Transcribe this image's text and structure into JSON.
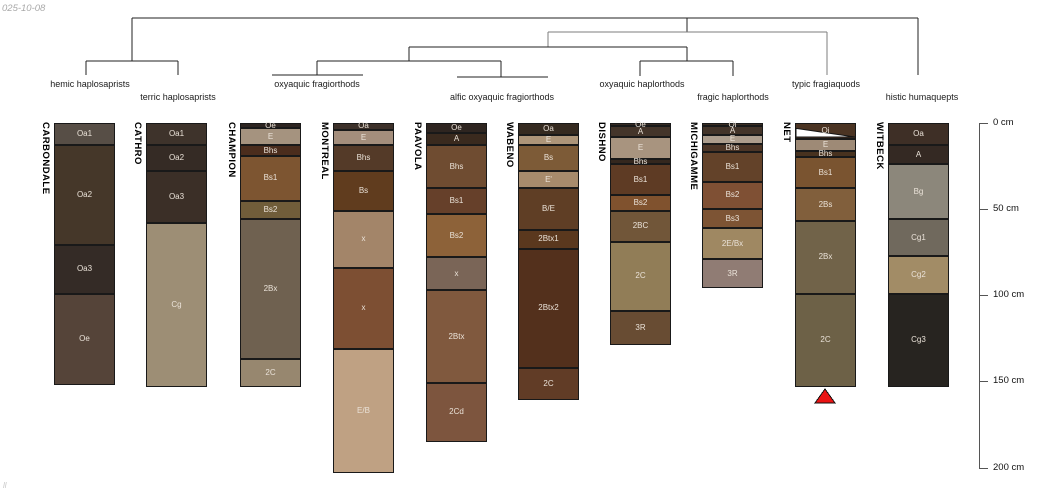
{
  "meta": {
    "date_label": "025-10-08",
    "corner_mark": "ll"
  },
  "chart_data": {
    "type": "soil-profile-dendrogram",
    "depth_axis": {
      "unit": "cm",
      "x_px": 979,
      "top_px": 123,
      "px_per_cm": 1.7226,
      "tick_len_px": 9,
      "label_x_px": 993,
      "ticks": [
        0,
        50,
        100,
        150,
        200
      ],
      "tick_labels": [
        "0 cm",
        "50 cm",
        "100 cm",
        "150 cm",
        "200 cm"
      ],
      "line_color": "#555555"
    },
    "dendrogram": {
      "line_color": "#222222",
      "gray_line_color": "#7d7d7d",
      "label_rows": {
        "upper": 79,
        "lower": 92
      },
      "segments": [
        {
          "x1": 132,
          "y1": 18,
          "x2": 918,
          "y2": 18
        },
        {
          "x1": 132,
          "y1": 18,
          "x2": 132,
          "y2": 61
        },
        {
          "x1": 918,
          "y1": 18,
          "x2": 918,
          "y2": 75
        },
        {
          "x1": 687,
          "y1": 18,
          "x2": 687,
          "y2": 32
        },
        {
          "x1": 548,
          "y1": 32,
          "x2": 827,
          "y2": 32,
          "gray": true
        },
        {
          "x1": 548,
          "y1": 32,
          "x2": 548,
          "y2": 47,
          "gray": true
        },
        {
          "x1": 827,
          "y1": 32,
          "x2": 827,
          "y2": 75,
          "gray": true
        },
        {
          "x1": 409,
          "y1": 47,
          "x2": 687,
          "y2": 47
        },
        {
          "x1": 409,
          "y1": 47,
          "x2": 409,
          "y2": 61
        },
        {
          "x1": 687,
          "y1": 47,
          "x2": 687,
          "y2": 61
        },
        {
          "x1": 640,
          "y1": 61,
          "x2": 733,
          "y2": 61
        },
        {
          "x1": 640,
          "y1": 61,
          "x2": 640,
          "y2": 76
        },
        {
          "x1": 733,
          "y1": 61,
          "x2": 733,
          "y2": 76
        },
        {
          "x1": 317,
          "y1": 61,
          "x2": 501,
          "y2": 61
        },
        {
          "x1": 317,
          "y1": 61,
          "x2": 317,
          "y2": 75
        },
        {
          "x1": 501,
          "y1": 61,
          "x2": 501,
          "y2": 77
        },
        {
          "x1": 272,
          "y1": 75,
          "x2": 363,
          "y2": 75
        },
        {
          "x1": 457,
          "y1": 77,
          "x2": 548,
          "y2": 77
        },
        {
          "x1": 86,
          "y1": 61,
          "x2": 178,
          "y2": 61
        },
        {
          "x1": 86,
          "y1": 61,
          "x2": 86,
          "y2": 75
        },
        {
          "x1": 178,
          "y1": 61,
          "x2": 178,
          "y2": 75
        }
      ],
      "labels": [
        {
          "text": "hemic haplosaprists",
          "x": 90,
          "row": "upper"
        },
        {
          "text": "terric haplosaprists",
          "x": 178,
          "row": "lower"
        },
        {
          "text": "oxyaquic fragiorthods",
          "x": 317,
          "row": "upper"
        },
        {
          "text": "alfic oxyaquic fragiorthods",
          "x": 502,
          "row": "lower"
        },
        {
          "text": "oxyaquic haplorthods",
          "x": 642,
          "row": "upper"
        },
        {
          "text": "fragic haplorthods",
          "x": 733,
          "row": "lower"
        },
        {
          "text": "typic fragiaquods",
          "x": 826,
          "row": "upper"
        },
        {
          "text": "histic humaquepts",
          "x": 922,
          "row": "lower"
        }
      ]
    },
    "marker": {
      "shape": "triangle-up",
      "profile": "NET",
      "x": 825,
      "apex_y": 389,
      "base_y": 403,
      "half_width": 10,
      "fill": "#ea1313",
      "stroke": "#111111"
    },
    "profiles": [
      {
        "name": "CARBONDALE",
        "x_px": 54,
        "width_px": 61,
        "horizons": [
          {
            "name": "Oa1",
            "top_cm": 0,
            "bottom_cm": 13,
            "color": "#574e46"
          },
          {
            "name": "Oa2",
            "top_cm": 13,
            "bottom_cm": 71,
            "color": "#453729"
          },
          {
            "name": "Oa3",
            "top_cm": 71,
            "bottom_cm": 99,
            "color": "#342b26"
          },
          {
            "name": "Oe",
            "top_cm": 99,
            "bottom_cm": 152,
            "color": "#554439"
          }
        ]
      },
      {
        "name": "CATHRO",
        "x_px": 146,
        "width_px": 61,
        "horizons": [
          {
            "name": "Oa1",
            "top_cm": 0,
            "bottom_cm": 13,
            "color": "#3e332b"
          },
          {
            "name": "Oa2",
            "top_cm": 13,
            "bottom_cm": 28,
            "color": "#352b25"
          },
          {
            "name": "Oa3",
            "top_cm": 28,
            "bottom_cm": 58,
            "color": "#3b2f27"
          },
          {
            "name": "Cg",
            "top_cm": 58,
            "bottom_cm": 153,
            "color": "#9d8e75"
          }
        ]
      },
      {
        "name": "CHAMPION",
        "x_px": 240,
        "width_px": 61,
        "horizons": [
          {
            "name": "Oe",
            "top_cm": 0,
            "bottom_cm": 3,
            "color": "#2d2521"
          },
          {
            "name": "E",
            "top_cm": 3,
            "bottom_cm": 13,
            "color": "#a5937f"
          },
          {
            "name": "Bhs",
            "top_cm": 13,
            "bottom_cm": 19,
            "color": "#4b2d1d"
          },
          {
            "name": "Bs1",
            "top_cm": 19,
            "bottom_cm": 45,
            "color": "#7d5531"
          },
          {
            "name": "Bs2",
            "top_cm": 45,
            "bottom_cm": 56,
            "color": "#705d3a"
          },
          {
            "name": "2Bx",
            "top_cm": 56,
            "bottom_cm": 137,
            "color": "#6f6150"
          },
          {
            "name": "2C",
            "top_cm": 137,
            "bottom_cm": 153,
            "color": "#97876f"
          }
        ]
      },
      {
        "name": "MONTREAL",
        "x_px": 333,
        "width_px": 61,
        "horizons": [
          {
            "name": "Oa",
            "top_cm": 0,
            "bottom_cm": 4,
            "color": "#3c3029"
          },
          {
            "name": "E",
            "top_cm": 4,
            "bottom_cm": 13,
            "color": "#a48e7c"
          },
          {
            "name": "Bhs",
            "top_cm": 13,
            "bottom_cm": 28,
            "color": "#543a28"
          },
          {
            "name": "Bs",
            "top_cm": 28,
            "bottom_cm": 51,
            "color": "#603c1e"
          },
          {
            "name": "x",
            "top_cm": 51,
            "bottom_cm": 84,
            "color": "#a38569"
          },
          {
            "name": "x",
            "top_cm": 84,
            "bottom_cm": 131,
            "color": "#7d4f33"
          },
          {
            "name": "E/B",
            "top_cm": 131,
            "bottom_cm": 203,
            "color": "#bfa183"
          }
        ]
      },
      {
        "name": "PAAVOLA",
        "x_px": 426,
        "width_px": 61,
        "horizons": [
          {
            "name": "Oe",
            "top_cm": 0,
            "bottom_cm": 6,
            "color": "#2e2520"
          },
          {
            "name": "A",
            "top_cm": 6,
            "bottom_cm": 13,
            "color": "#3a2a1e"
          },
          {
            "name": "Bhs",
            "top_cm": 13,
            "bottom_cm": 38,
            "color": "#6f4c31"
          },
          {
            "name": "Bs1",
            "top_cm": 38,
            "bottom_cm": 53,
            "color": "#66402a"
          },
          {
            "name": "Bs2",
            "top_cm": 53,
            "bottom_cm": 78,
            "color": "#8d6239"
          },
          {
            "name": "x",
            "top_cm": 78,
            "bottom_cm": 97,
            "color": "#7a6557"
          },
          {
            "name": "2Btx",
            "top_cm": 97,
            "bottom_cm": 151,
            "color": "#80593e"
          },
          {
            "name": "2Cd",
            "top_cm": 151,
            "bottom_cm": 185,
            "color": "#7d553e"
          }
        ]
      },
      {
        "name": "WABENO",
        "x_px": 518,
        "width_px": 61,
        "horizons": [
          {
            "name": "Oa",
            "top_cm": 0,
            "bottom_cm": 7,
            "color": "#352a20"
          },
          {
            "name": "E",
            "top_cm": 7,
            "bottom_cm": 13,
            "color": "#ad9579"
          },
          {
            "name": "Bs",
            "top_cm": 13,
            "bottom_cm": 28,
            "color": "#7d5b37"
          },
          {
            "name": "E'",
            "top_cm": 28,
            "bottom_cm": 38,
            "color": "#a78b6c"
          },
          {
            "name": "B/E",
            "top_cm": 38,
            "bottom_cm": 62,
            "color": "#5f3e25"
          },
          {
            "name": "2Btx1",
            "top_cm": 62,
            "bottom_cm": 73,
            "color": "#5a381e"
          },
          {
            "name": "2Btx2",
            "top_cm": 73,
            "bottom_cm": 142,
            "color": "#53301c"
          },
          {
            "name": "2C",
            "top_cm": 142,
            "bottom_cm": 161,
            "color": "#613c26"
          }
        ]
      },
      {
        "name": "DISHNO",
        "x_px": 610,
        "width_px": 61,
        "horizons": [
          {
            "name": "Oe",
            "top_cm": 0,
            "bottom_cm": 2,
            "color": "#352a23"
          },
          {
            "name": "A",
            "top_cm": 2,
            "bottom_cm": 8,
            "color": "#44352a"
          },
          {
            "name": "E",
            "top_cm": 8,
            "bottom_cm": 21,
            "color": "#a8947f"
          },
          {
            "name": "Bhs",
            "top_cm": 21,
            "bottom_cm": 24,
            "color": "#34271e"
          },
          {
            "name": "Bs1",
            "top_cm": 24,
            "bottom_cm": 42,
            "color": "#5e3b24"
          },
          {
            "name": "Bs2",
            "top_cm": 42,
            "bottom_cm": 51,
            "color": "#80522e"
          },
          {
            "name": "2BC",
            "top_cm": 51,
            "bottom_cm": 69,
            "color": "#715639"
          },
          {
            "name": "2C",
            "top_cm": 69,
            "bottom_cm": 109,
            "color": "#917d57"
          },
          {
            "name": "3R",
            "top_cm": 109,
            "bottom_cm": 129,
            "color": "#684c33"
          }
        ]
      },
      {
        "name": "MICHIGAMME",
        "x_px": 702,
        "width_px": 61,
        "horizons": [
          {
            "name": "Oi",
            "top_cm": 0,
            "bottom_cm": 2,
            "color": "#3a2d23"
          },
          {
            "name": "A",
            "top_cm": 2,
            "bottom_cm": 7,
            "color": "#433429"
          },
          {
            "name": "E",
            "top_cm": 7,
            "bottom_cm": 12,
            "color": "#ac9d8d"
          },
          {
            "name": "Bhs",
            "top_cm": 12,
            "bottom_cm": 17,
            "color": "#4c3526"
          },
          {
            "name": "Bs1",
            "top_cm": 17,
            "bottom_cm": 34,
            "color": "#634229"
          },
          {
            "name": "Bs2",
            "top_cm": 34,
            "bottom_cm": 50,
            "color": "#7f5034"
          },
          {
            "name": "Bs3",
            "top_cm": 50,
            "bottom_cm": 61,
            "color": "#7d5434"
          },
          {
            "name": "2E/Bx",
            "top_cm": 61,
            "bottom_cm": 79,
            "color": "#9f8862"
          },
          {
            "name": "3R",
            "top_cm": 79,
            "bottom_cm": 96,
            "color": "#907c74"
          }
        ]
      },
      {
        "name": "NET",
        "x_px": 795,
        "width_px": 61,
        "horizons": [
          {
            "name": "Oi",
            "top_cm": 0,
            "bottom_cm": 9,
            "color": "#4b3423",
            "wedge": true
          },
          {
            "name": "E",
            "top_cm": 9,
            "bottom_cm": 16,
            "color": "#9e8a76"
          },
          {
            "name": "Bhs",
            "top_cm": 16,
            "bottom_cm": 20,
            "color": "#48321f"
          },
          {
            "name": "Bs1",
            "top_cm": 20,
            "bottom_cm": 38,
            "color": "#7a5430"
          },
          {
            "name": "2Bs",
            "top_cm": 38,
            "bottom_cm": 57,
            "color": "#815f3c"
          },
          {
            "name": "2Bx",
            "top_cm": 57,
            "bottom_cm": 99,
            "color": "#716349"
          },
          {
            "name": "2C",
            "top_cm": 99,
            "bottom_cm": 153,
            "color": "#6d6147"
          }
        ]
      },
      {
        "name": "WITBECK",
        "x_px": 888,
        "width_px": 61,
        "horizons": [
          {
            "name": "Oa",
            "top_cm": 0,
            "bottom_cm": 13,
            "color": "#3e2f26"
          },
          {
            "name": "A",
            "top_cm": 13,
            "bottom_cm": 24,
            "color": "#342923"
          },
          {
            "name": "Bg",
            "top_cm": 24,
            "bottom_cm": 56,
            "color": "#8c877b"
          },
          {
            "name": "Cg1",
            "top_cm": 56,
            "bottom_cm": 77,
            "color": "#70695d"
          },
          {
            "name": "Cg2",
            "top_cm": 77,
            "bottom_cm": 99,
            "color": "#a28c66"
          },
          {
            "name": "Cg3",
            "top_cm": 99,
            "bottom_cm": 153,
            "color": "#272420"
          }
        ]
      }
    ]
  }
}
